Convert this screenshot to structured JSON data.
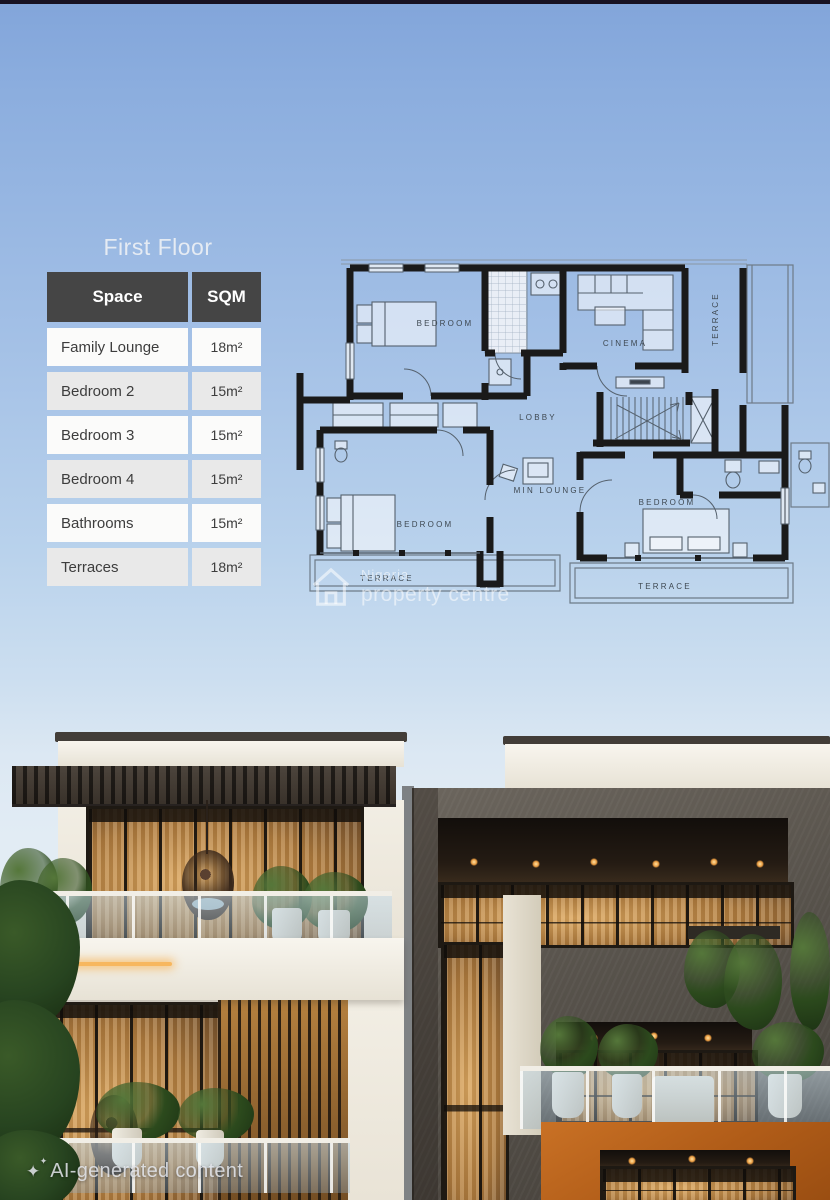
{
  "title": "First Floor",
  "table": {
    "headers": [
      "Space",
      "SQM"
    ],
    "rows": [
      {
        "space": "Family Lounge",
        "sqm": "18m²"
      },
      {
        "space": "Bedroom 2",
        "sqm": "15m²"
      },
      {
        "space": "Bedroom 3",
        "sqm": "15m²"
      },
      {
        "space": "Bedroom 4",
        "sqm": "15m²"
      },
      {
        "space": "Bathrooms",
        "sqm": "15m²"
      },
      {
        "space": "Terraces",
        "sqm": "18m²"
      }
    ]
  },
  "floor_plan": {
    "labels": {
      "bedroom": "BEDROOM",
      "cinema": "CINEMA",
      "terrace": "TERRACE",
      "lobby": "LOBBY",
      "min_lounge": "MIN LOUNGE"
    }
  },
  "watermark": {
    "line1": "Nigeria",
    "line2": "property centre"
  },
  "footer": {
    "ai_label": "AI-generated content",
    "sparkle_icon": "✦"
  },
  "colors": {
    "sky_top": "#82a5da",
    "sky_bottom": "#e2ecf4",
    "top_strip": "#171222",
    "table_header_bg": "#454545",
    "table_row_alt": "#e9e9e9",
    "plan_wall": "#1a1a1a",
    "watermark_white": "rgba(255,255,255,0.55)",
    "accent_orange": "#b05c18",
    "warm_window_glow": "#c4924f"
  }
}
